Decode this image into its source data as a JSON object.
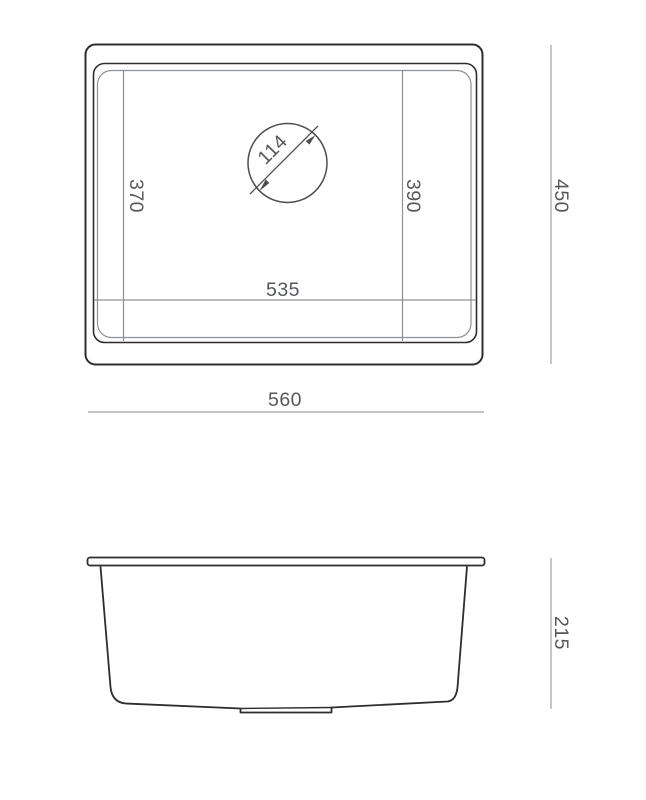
{
  "dimensions": {
    "top_view": {
      "overall_width": "560",
      "overall_depth": "450",
      "bowl_width": "535",
      "bowl_depth_left": "370",
      "bowl_depth_right": "390",
      "drain_diameter": "114"
    },
    "side_view": {
      "overall_height": "215"
    }
  },
  "colors": {
    "outline": "#2d2d2d",
    "drain_line": "#4a4e52",
    "secondary_line": "#8d9094",
    "dimension_line": "#9aa0a4",
    "label_text": "#54575b",
    "background": "#ffffff"
  }
}
